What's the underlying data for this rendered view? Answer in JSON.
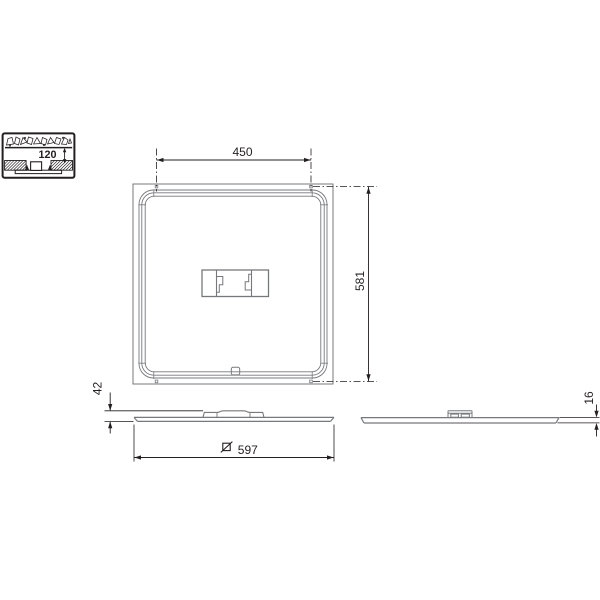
{
  "drawing_title": "luminaire-dimension-drawing",
  "colors": {
    "background": "#ffffff",
    "drawing_line": "#77787B",
    "dimension_line": "#231F20",
    "text": "#231F20"
  },
  "detail_inset": {
    "recess_depth": "120"
  },
  "plan_view": {
    "suspension_width": "450",
    "suspension_height": "581"
  },
  "front_view": {
    "total_height": "42",
    "square_size": "597"
  },
  "side_view": {
    "panel_thickness": "16"
  }
}
